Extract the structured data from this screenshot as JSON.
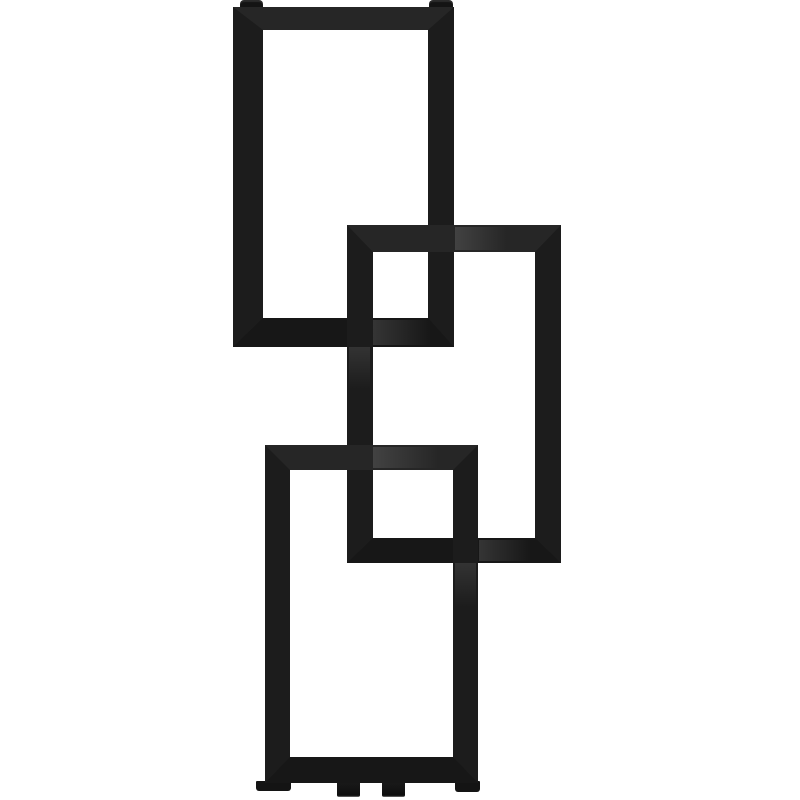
{
  "colors": {
    "background": "#ffffff",
    "frame": "#1c1c1c",
    "frame_top_face": "#262626",
    "frame_bottom_face": "#171717",
    "fitting": "#141414",
    "pipe": "#1a1a1a"
  },
  "parts": {
    "frames": [
      {
        "name": "top-frame"
      },
      {
        "name": "middle-frame"
      },
      {
        "name": "bottom-frame"
      }
    ],
    "fittings": [
      "air-vent-cap-left",
      "air-vent-cap-right",
      "foot-left",
      "foot-right",
      "inlet-pipe-left",
      "inlet-pipe-right"
    ]
  }
}
